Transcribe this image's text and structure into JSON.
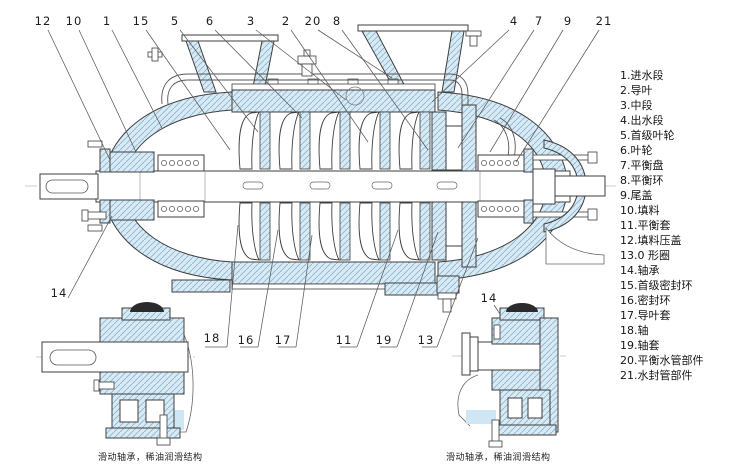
{
  "legend": {
    "items": [
      "1.进水段",
      "2.导叶",
      "3.中段",
      "4.出水段",
      "5.首级叶轮",
      "6.叶轮",
      "7.平衡盘",
      "8.平衡环",
      "9.尾盖",
      "10.填料",
      "11.平衡套",
      "12.填料压盖",
      "13.0 形圈",
      "14.轴承",
      "15.首级密封环",
      "16.密封环",
      "17.导叶套",
      "18.轴",
      "19.轴套",
      "20.平衡水管部件",
      "21.水封管部件"
    ]
  },
  "callouts": {
    "top": [
      "12",
      "10",
      "1",
      "15",
      "5",
      "6",
      "3",
      "2",
      "20",
      "8",
      "4",
      "7",
      "9",
      "21"
    ],
    "bottom": [
      "18",
      "16",
      "17",
      "11",
      "19",
      "13"
    ],
    "bottom_left": "14",
    "bottom_right": "14"
  },
  "captions": {
    "left": "滑动轴承，稀油润滑结构",
    "right": "滑动轴承，稀油润滑结构"
  },
  "colors": {
    "part_fill": "#d8eaf5",
    "hatch_line": "#8fb6cc",
    "outline": "#3f3f3f",
    "dark_cap": "#2b2b2b"
  }
}
